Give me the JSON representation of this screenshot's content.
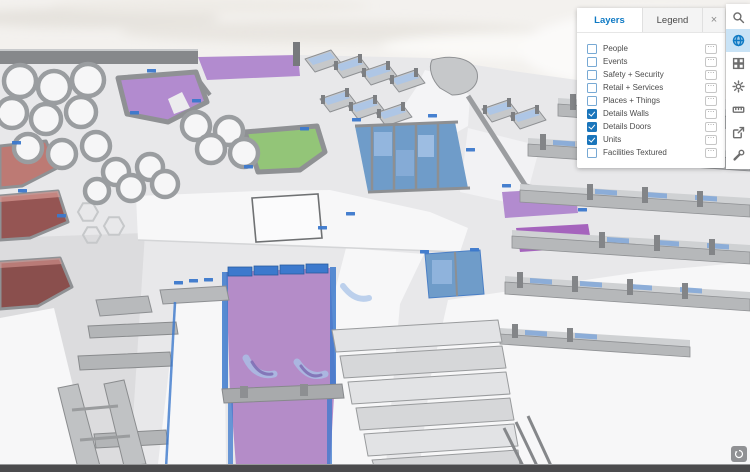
{
  "panel": {
    "tabs": [
      {
        "label": "Layers",
        "active": true
      },
      {
        "label": "Legend",
        "active": false
      }
    ],
    "close_glyph": "×",
    "layers": [
      {
        "label": "People",
        "checked": false
      },
      {
        "label": "Events",
        "checked": false
      },
      {
        "label": "Safety + Security",
        "checked": false
      },
      {
        "label": "Retail + Services",
        "checked": false
      },
      {
        "label": "Places + Things",
        "checked": false
      },
      {
        "label": "Details Walls",
        "checked": true
      },
      {
        "label": "Details Doors",
        "checked": true
      },
      {
        "label": "Units",
        "checked": true
      },
      {
        "label": "Facilities Textured",
        "checked": false
      }
    ]
  },
  "toolbar": {
    "tools": [
      {
        "name": "search",
        "active": false
      },
      {
        "name": "globe",
        "active": true
      },
      {
        "name": "basemap-grid",
        "active": false
      },
      {
        "name": "gear",
        "active": false
      },
      {
        "name": "measure",
        "active": false
      },
      {
        "name": "export",
        "active": false
      },
      {
        "name": "wrench",
        "active": false
      }
    ]
  },
  "icons": {
    "layer_options": "⋯"
  },
  "colors": {
    "accent_blue": "#0f7ac4",
    "checkbox_checked": "#1a75bb",
    "active_tool_bg": "#c9e3f6",
    "unit_purple": "#b28bcf",
    "unit_purple_dark": "#a564bd",
    "unit_green": "#93c578",
    "unit_blue": "#6f9cc9",
    "unit_blue_light": "#8fb3dc",
    "unit_red": "#bd7a74",
    "unit_maroon": "#955553",
    "door_blue": "#3c79cd",
    "glass_blue": "#a9c6ea",
    "wall_gray": "#8f9194",
    "floor_gray": "#e8e8ea",
    "walkway_white": "#f7f7f8"
  }
}
